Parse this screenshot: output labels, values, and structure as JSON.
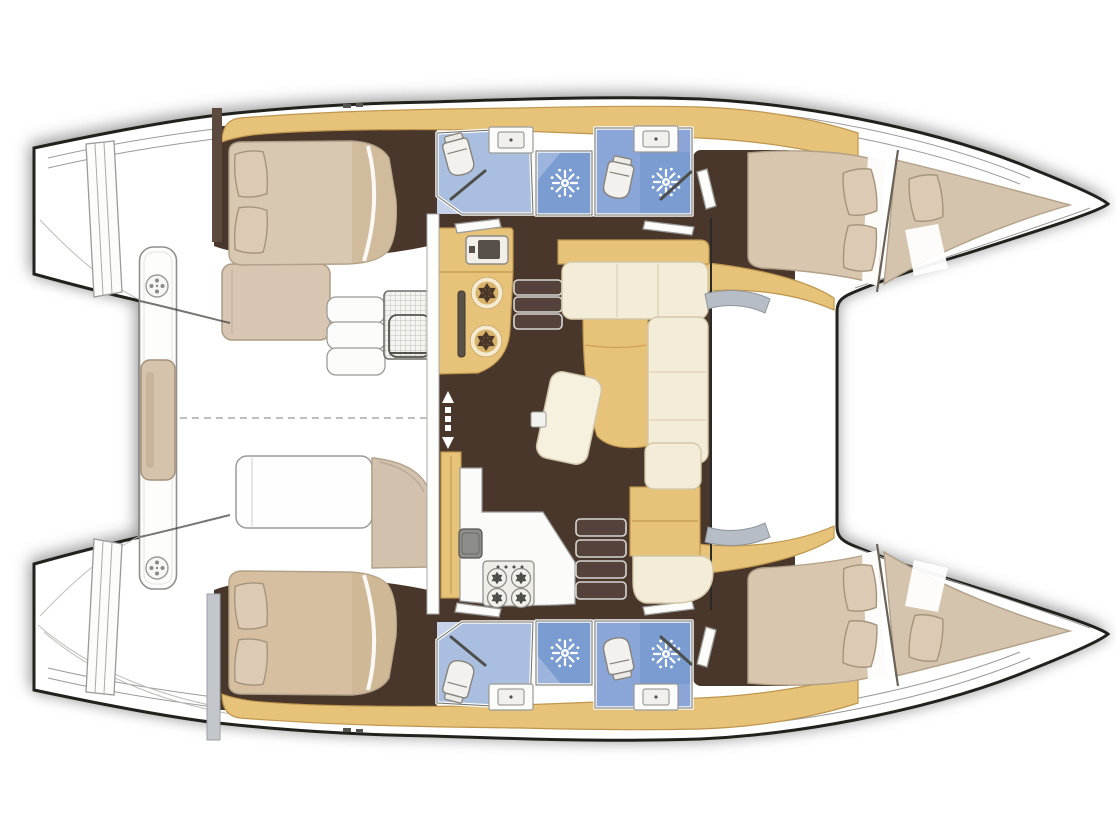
{
  "document": {
    "kind": "boat-floor-plan",
    "vessel": "catamaran",
    "view": "top-down interior layout, bows to the right, transom steps to the left"
  },
  "palette": {
    "background": "#ffffff",
    "outline": "#20201e",
    "wood": "#e7c279",
    "wood_edge": "#bf964d",
    "floor": "#4a372c",
    "bed": "#d8c7b1",
    "bed_shade": "#cdb795",
    "cushion": "#f3ecd8",
    "pillow": "#dccab4",
    "bath_light": "#aabfe0",
    "bath_mid": "#8aa6d8",
    "bath_dark": "#7b9cd1",
    "fixture": "#fbfbf9",
    "window": "#b7bdc5"
  },
  "regions": {
    "port_hull": {
      "label": "Port hull (top): aft double cabin with pillows, two bathrooms with toilet, sink and shower, forward double cabin and forepeak berth"
    },
    "starboard_hull": {
      "label": "Starboard hull (bottom): aft double cabin with pillows, two bathrooms with toilet, sink and shower, forward double cabin and forepeak berth"
    },
    "salon": {
      "label": "Bridgedeck salon: galley with twin round burners and oven, four-burner stove with sink, L-shaped sofa with table, companionway steps to each hull, sliding door with arrows"
    },
    "cockpit": {
      "label": "Aft cockpit: bench cushions, slatted table, white seat pads, aft crossbeam with center cushion and deck hatches"
    },
    "bows": {
      "label": "Twin pointed bows"
    },
    "sterns": {
      "label": "Twin transoms with boarding steps"
    }
  },
  "inventory": {
    "double_berths": 4,
    "forepeak_berths": 2,
    "toilets": 4,
    "showers": 4,
    "bathroom_sinks": 4,
    "stove_burners_large": 2,
    "stove_burners_small": 4,
    "companionway_stairs": 2,
    "deck_hatches": 2
  },
  "icons": {
    "shower_icon": "sun-burst spray",
    "toilet_icon": "rounded bowl with tank",
    "hatch_icon": "circle with four dots",
    "burner_icon": "circle with six petals",
    "door_icon": "up-down arrows",
    "table_icon": "slatted grid rectangle"
  }
}
